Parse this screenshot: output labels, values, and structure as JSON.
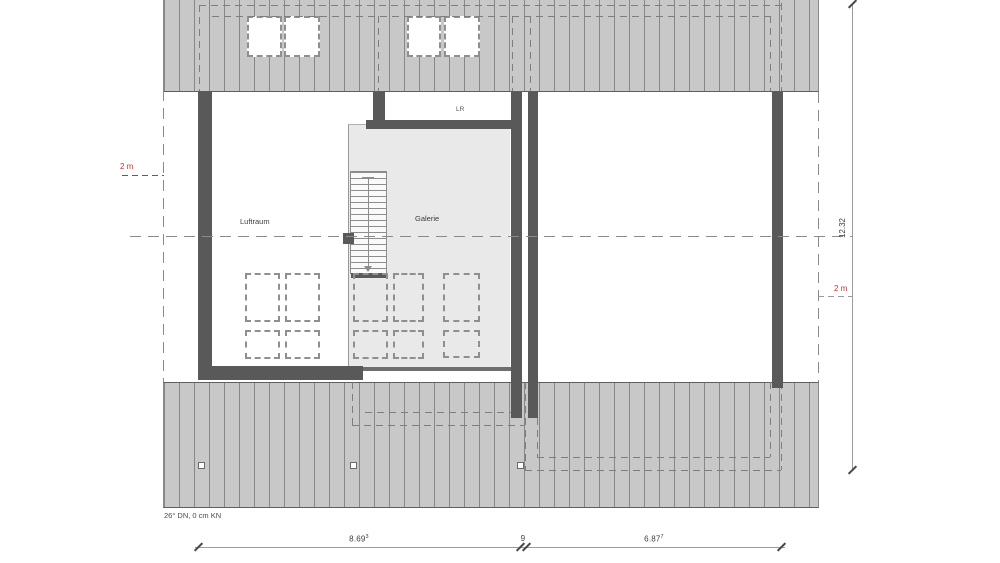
{
  "drawing": {
    "rooms": {
      "luftraum": "Luftraum",
      "galerie": "Galerie",
      "lr": "LR"
    },
    "roof_note": "26° DN, 0 cm KN",
    "dimensions": {
      "vertical_total": "12.32",
      "bottom_left_main": "8.69",
      "bottom_left_sup": "3",
      "bottom_middle": "9",
      "bottom_right_main": "6.87",
      "bottom_right_sup": "7",
      "height_marker_left": "2 m",
      "height_marker_right": "2 m"
    },
    "colors": {
      "accent_red": "#c6332e",
      "wall": "#595959",
      "roof_fill": "#c8c8c8",
      "roof_hatch_line": "#707070",
      "galerie_fill": "#e9e9e9",
      "dashed_line": "#7d7d7d",
      "dimension_line": "#9b9b9b"
    }
  }
}
